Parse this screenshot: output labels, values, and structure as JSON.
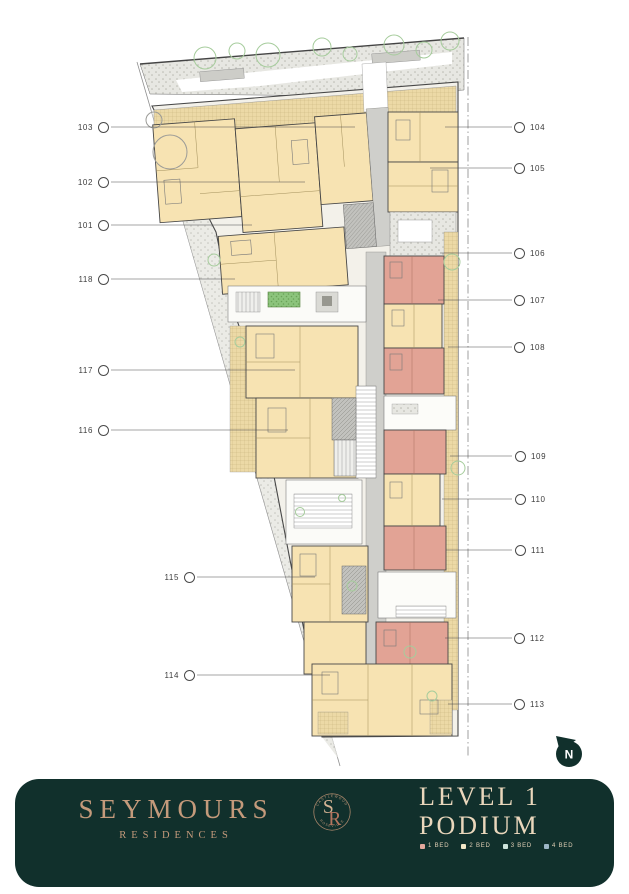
{
  "plan": {
    "callouts": {
      "left": [
        {
          "label": "103"
        },
        {
          "label": "102"
        },
        {
          "label": "101"
        },
        {
          "label": "118"
        },
        {
          "label": "117"
        },
        {
          "label": "116"
        },
        {
          "label": "115"
        },
        {
          "label": "114"
        }
      ],
      "right": [
        {
          "label": "104"
        },
        {
          "label": "105"
        },
        {
          "label": "106"
        },
        {
          "label": "107"
        },
        {
          "label": "108"
        },
        {
          "label": "109"
        },
        {
          "label": "110"
        },
        {
          "label": "111"
        },
        {
          "label": "112"
        },
        {
          "label": "113"
        }
      ]
    },
    "north_label": "N",
    "unit_colors": {
      "one_bed": "#e2a395",
      "two_bed": "#f7e3b2",
      "three_bed": "#cfe4dc",
      "four_bed": "#9db6c6"
    }
  },
  "footer": {
    "brand_name": "SEYMOURS",
    "brand_subtitle": "RESIDENCES",
    "monogram": {
      "top": "CASTLEWOOD",
      "letter_s": "S",
      "letter_r": "R",
      "bottom": "ROSEVILLE"
    },
    "title_line1": "LEVEL 1",
    "title_line2": "PODIUM",
    "legend": [
      {
        "label": "1 BED",
        "color": "#e3a89c"
      },
      {
        "label": "2 BED",
        "color": "#f2e8c8"
      },
      {
        "label": "3 BED",
        "color": "#cfe4dc"
      },
      {
        "label": "4 BED",
        "color": "#9db6c6"
      }
    ]
  }
}
